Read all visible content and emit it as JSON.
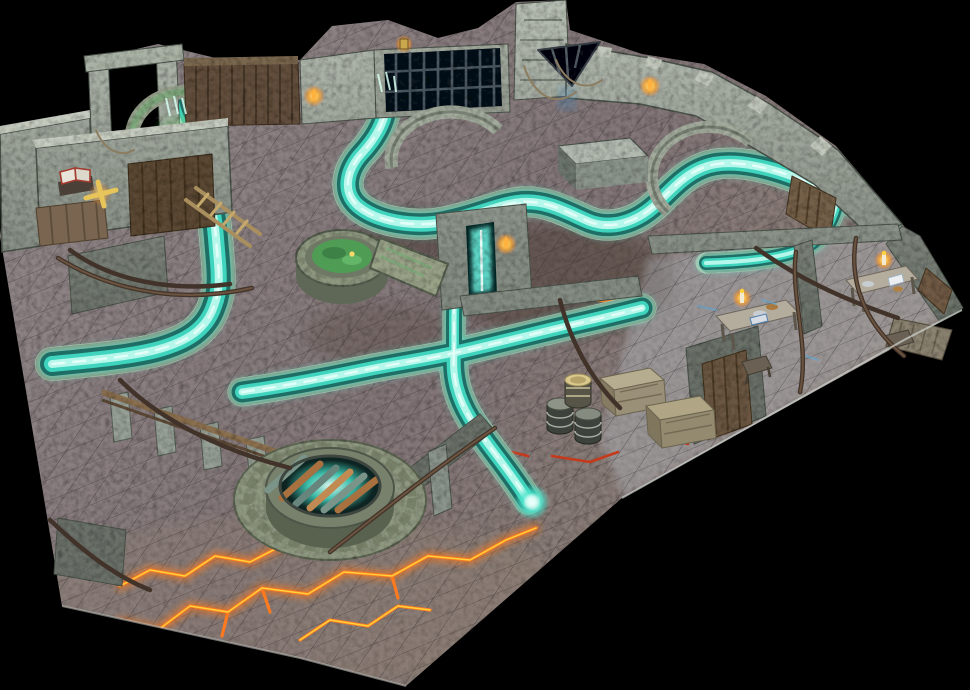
{
  "scene": {
    "subject": "Photograph of a modular tabletop dungeon terrain board on a black background",
    "view": "high-angle three-quarter perspective",
    "content": "stone-tiled dungeon floor with glowing turquoise river channels, ruined stone walls and arches, a round barred grate over glowing water, a green well pool, lava cracks, barrels, crates, candle-lit tables, a ladder, doors and torches"
  },
  "palette": {
    "background": "#000000",
    "floor_stone": "#847a7d",
    "floor_rooms": "#b9c1c9",
    "wall_light": "#b7beb3",
    "wall_mid": "#8b948c",
    "wall_dark": "#666e66",
    "river_bank": "#b7c0ab",
    "river_glow": "#58e8d2",
    "river_deep": "#1f6e66",
    "river_mid": "#3fd4bd",
    "river_core": "#b5f7ea",
    "river_foam": "#eafffa",
    "lava_orange": "#ff7a1f",
    "lava_yellow": "#ffd23c",
    "lava_red": "#c63a1c",
    "well_green": "#4f9d55",
    "wood": "#6b5743",
    "wood_light": "#a98e5e",
    "root_brown": "#42332a",
    "flame_orange": "#ffb23e",
    "candle_yellow": "#ffd23c",
    "grate_rust": "#a9713f",
    "grate_teal": "#7b948a",
    "door_glow_cyan": "#67e8d8"
  },
  "features": {
    "river_network": "glowing turquoise channels with cobbled stone banks",
    "round_grate": "raised circular stone grate with rusted bars over glowing water",
    "green_well": "round stone well with green pool and leaning stone lid",
    "lava_cracks": "orange and yellow glowing cracks across the lower floor",
    "props": "barrels, wooden crates, two candle-lit tables, ladder, open spellbook, trapdoor, wooden doors, wall torches, stone altar, ruined walls with roots"
  }
}
